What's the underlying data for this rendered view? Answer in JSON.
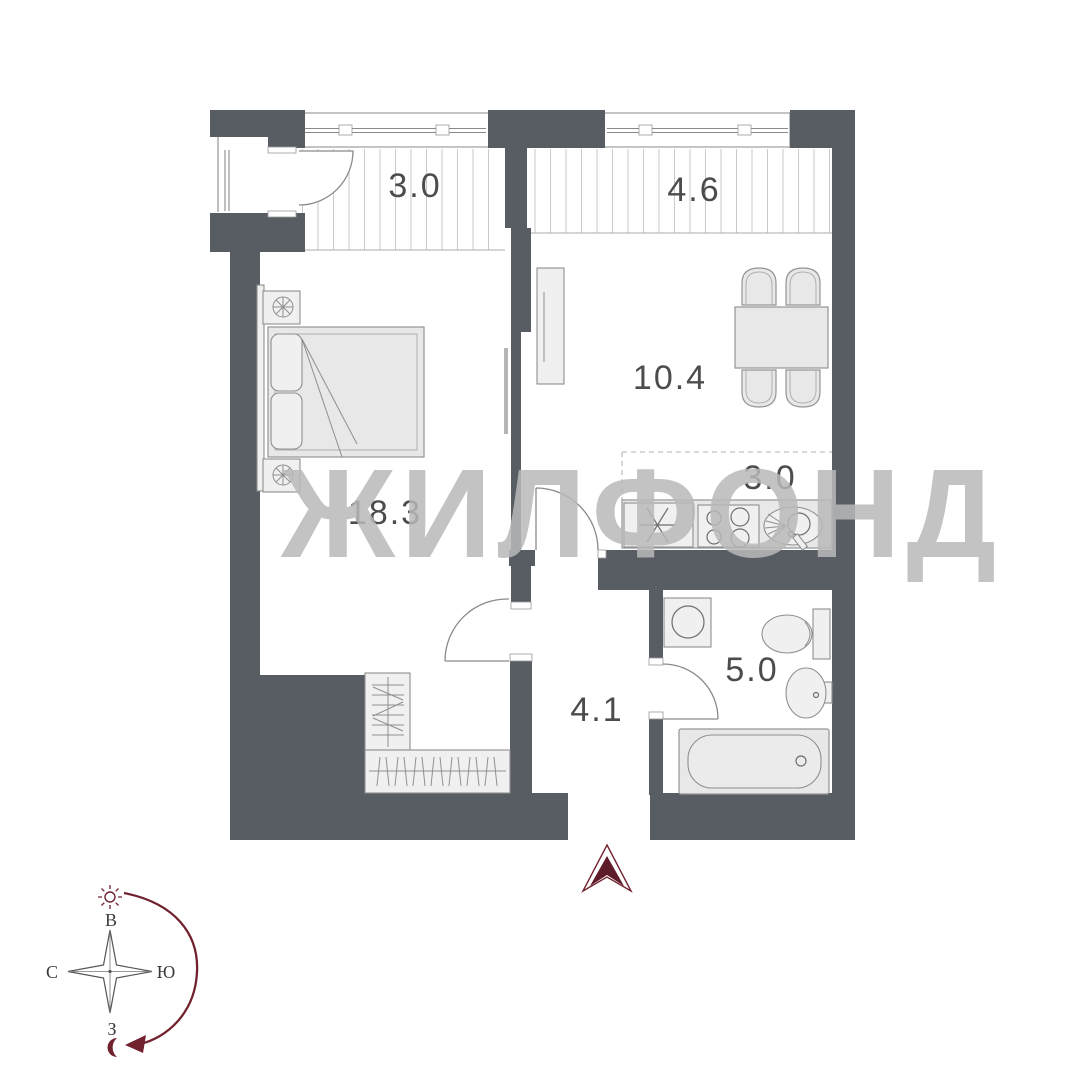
{
  "floorplan": {
    "rooms": [
      {
        "name": "balcony-left",
        "area": "3.0"
      },
      {
        "name": "balcony-right",
        "area": "4.6"
      },
      {
        "name": "kitchen-living",
        "area": "10.4"
      },
      {
        "name": "kitchen-niche",
        "area": "3.0"
      },
      {
        "name": "bedroom",
        "area": "18.3"
      },
      {
        "name": "hallway",
        "area": "4.1"
      },
      {
        "name": "bathroom",
        "area": "5.0"
      }
    ]
  },
  "watermark": {
    "text": "ЖИЛФОНД"
  },
  "compass": {
    "top": "В",
    "right": "Ю",
    "left": "С",
    "bottom": "З"
  },
  "icons": [
    "entrance-arrow-icon",
    "sun-icon",
    "moon-icon",
    "compass-rose",
    "sun-path-arrow-icon"
  ],
  "colors": {
    "wall": "#585d64",
    "accent": "#72222f",
    "label": "#4c4c4c",
    "watermark": "rgba(185,185,185,0.85)",
    "hatch": "#c9c9c9",
    "furniture": "#e8e8e9"
  }
}
